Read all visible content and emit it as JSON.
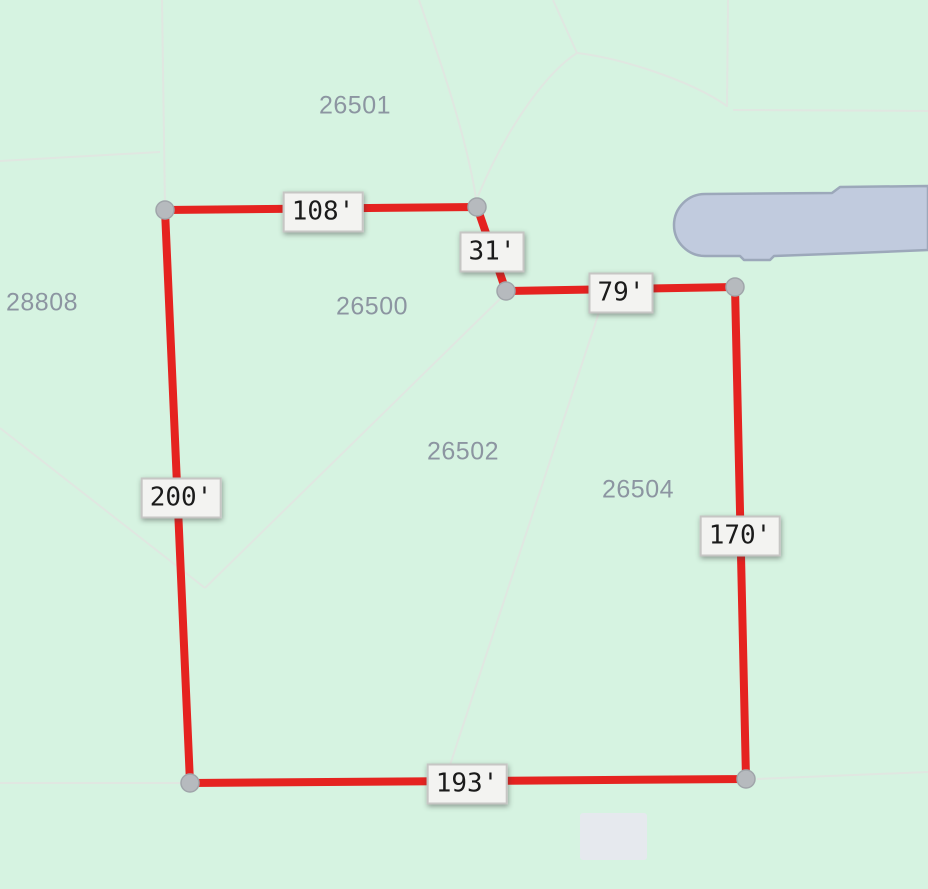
{
  "map": {
    "colors": {
      "background": "#d6f3e1",
      "boundary_red": "#e52320",
      "vertex_fill": "#b6babe",
      "vertex_stroke": "#a0a5aa",
      "parcel_text": "#8c95a1",
      "dimension_text": "#1b1b1b",
      "dimension_box_bg": "#f3f3f1",
      "dimension_box_border": "#c6c6c4",
      "water_fill": "#c1cbde",
      "water_stroke": "#9ca8ba",
      "building_fill": "#e6e9ee",
      "faint_parcel_line": "#e0e7e1"
    },
    "boundary": {
      "closed": true,
      "stroke_width": 8,
      "vertices": [
        [
          165,
          210
        ],
        [
          477,
          207
        ],
        [
          506,
          291
        ],
        [
          735,
          287
        ],
        [
          746,
          779
        ],
        [
          190,
          783
        ]
      ],
      "vertex_radius": 9
    },
    "dimension_labels": [
      {
        "text": "108'",
        "x": 323,
        "y": 212
      },
      {
        "text": "31'",
        "x": 492,
        "y": 252
      },
      {
        "text": "79'",
        "x": 621,
        "y": 293
      },
      {
        "text": "170'",
        "x": 740,
        "y": 536
      },
      {
        "text": "193'",
        "x": 467,
        "y": 784
      },
      {
        "text": "200'",
        "x": 181,
        "y": 498
      }
    ],
    "parcel_labels": [
      {
        "text": "26501",
        "x": 355,
        "y": 106
      },
      {
        "text": "28808",
        "x": 42,
        "y": 303
      },
      {
        "text": "26500",
        "x": 372,
        "y": 307
      },
      {
        "text": "26502",
        "x": 463,
        "y": 452
      },
      {
        "text": "26504",
        "x": 638,
        "y": 490
      }
    ],
    "water_body_path": "M 705 194 L 832 193 L 840 187 L 928 186 L 928 250 L 856 253 L 774 256 L 770 260 L 744 260 L 740 256 L 705 256 A 31 31 0 0 1 705 194 Z",
    "building_rect": {
      "x": 580,
      "y": 813,
      "w": 67,
      "h": 47,
      "rx": 3
    },
    "faint_lines": [
      "M 0 161 L 160 152",
      "M 162 0 L 165 208",
      "M 419 0 C 440 60 468 140 477 205",
      "M 553 0 L 577 53",
      "M 577 53 C 620 58 690 80 727 106",
      "M 577 53 C 550 70 510 120 478 196",
      "M 728 0 L 727 107",
      "M 733 110 L 928 111",
      "M 508 291 L 205 588",
      "M 0 428 L 205 588",
      "M 603 300 L 450 765",
      "M 757 779 L 928 772",
      "M 0 783 L 182 783"
    ]
  }
}
